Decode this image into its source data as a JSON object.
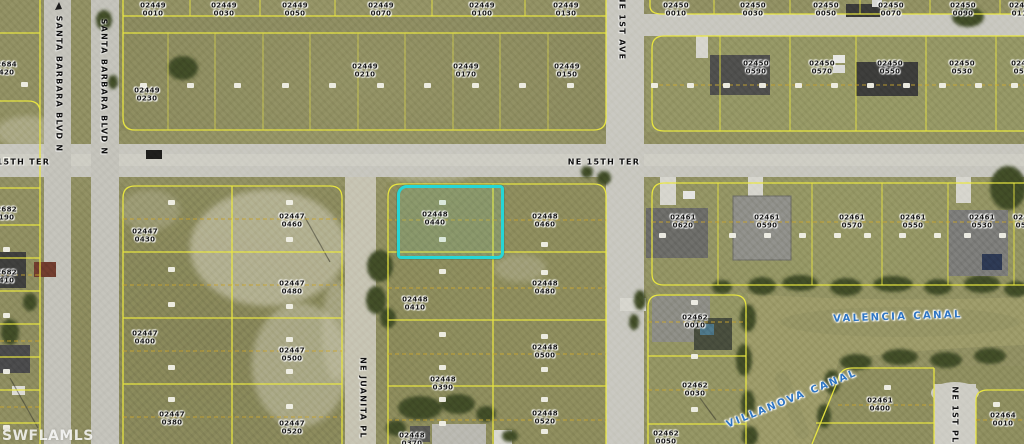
{
  "map": {
    "watermark": "SWFLAMLS",
    "colors": {
      "highlight": "#26d6d6",
      "parcel_line": "#ece93f",
      "parcel_line_dashed": "#c9a42e",
      "canal_text": "#2f76c4",
      "road": "#c7c6be",
      "land": "#8f8e61",
      "water": "#9b9968"
    },
    "highlighted_parcel": {
      "line1": "02448",
      "line2": "0440",
      "x": 397,
      "y": 185,
      "width": 101,
      "height": 68
    },
    "parcel_labels": [
      {
        "line1": "02449",
        "line2": "0010",
        "x": 153,
        "y": 10
      },
      {
        "line1": "02449",
        "line2": "0030",
        "x": 224,
        "y": 10
      },
      {
        "line1": "02449",
        "line2": "0050",
        "x": 295,
        "y": 10
      },
      {
        "line1": "02449",
        "line2": "0070",
        "x": 381,
        "y": 10
      },
      {
        "line1": "02449",
        "line2": "0100",
        "x": 482,
        "y": 10
      },
      {
        "line1": "02449",
        "line2": "0130",
        "x": 566,
        "y": 10
      },
      {
        "line1": "02449",
        "line2": "0230",
        "x": 147,
        "y": 95
      },
      {
        "line1": "02449",
        "line2": "0210",
        "x": 365,
        "y": 71
      },
      {
        "line1": "02449",
        "line2": "0170",
        "x": 466,
        "y": 71
      },
      {
        "line1": "02449",
        "line2": "0150",
        "x": 567,
        "y": 71
      },
      {
        "line1": "02450",
        "line2": "0010",
        "x": 676,
        "y": 10
      },
      {
        "line1": "02450",
        "line2": "0030",
        "x": 753,
        "y": 10
      },
      {
        "line1": "02450",
        "line2": "0050",
        "x": 826,
        "y": 10
      },
      {
        "line1": "02450",
        "line2": "0070",
        "x": 891,
        "y": 10
      },
      {
        "line1": "02450",
        "line2": "0090",
        "x": 963,
        "y": 10
      },
      {
        "line1": "02450",
        "line2": "0110",
        "x": 1022,
        "y": 10
      },
      {
        "line1": "02450",
        "line2": "0590",
        "x": 756,
        "y": 68
      },
      {
        "line1": "02450",
        "line2": "0570",
        "x": 822,
        "y": 68
      },
      {
        "line1": "02450",
        "line2": "0550",
        "x": 890,
        "y": 68
      },
      {
        "line1": "02450",
        "line2": "0530",
        "x": 962,
        "y": 68
      },
      {
        "line1": "02450",
        "line2": "0510",
        "x": 1024,
        "y": 68
      },
      {
        "line1": "02684",
        "line2": "0420",
        "x": 4,
        "y": 69
      },
      {
        "line1": "02682",
        "line2": "0190",
        "x": 4,
        "y": 214
      },
      {
        "line1": "02682",
        "line2": "0410",
        "x": 4,
        "y": 277
      },
      {
        "line1": "02447",
        "line2": "0430",
        "x": 145,
        "y": 236
      },
      {
        "line1": "02447",
        "line2": "0460",
        "x": 292,
        "y": 221
      },
      {
        "line1": "02447",
        "line2": "0480",
        "x": 292,
        "y": 288
      },
      {
        "line1": "02447",
        "line2": "0400",
        "x": 145,
        "y": 338
      },
      {
        "line1": "02447",
        "line2": "0500",
        "x": 292,
        "y": 355
      },
      {
        "line1": "02447",
        "line2": "0380",
        "x": 172,
        "y": 419
      },
      {
        "line1": "02447",
        "line2": "0520",
        "x": 292,
        "y": 428
      },
      {
        "line1": "02448",
        "line2": "0440",
        "x": 435,
        "y": 219
      },
      {
        "line1": "02448",
        "line2": "0460",
        "x": 545,
        "y": 221
      },
      {
        "line1": "02448",
        "line2": "0480",
        "x": 545,
        "y": 288
      },
      {
        "line1": "02448",
        "line2": "0410",
        "x": 415,
        "y": 304
      },
      {
        "line1": "02448",
        "line2": "0500",
        "x": 545,
        "y": 352
      },
      {
        "line1": "02448",
        "line2": "0390",
        "x": 443,
        "y": 384
      },
      {
        "line1": "02448",
        "line2": "0520",
        "x": 545,
        "y": 418
      },
      {
        "line1": "02448",
        "line2": "0370",
        "x": 412,
        "y": 440
      },
      {
        "line1": "02461",
        "line2": "0620",
        "x": 683,
        "y": 222
      },
      {
        "line1": "02461",
        "line2": "0590",
        "x": 767,
        "y": 222
      },
      {
        "line1": "02461",
        "line2": "0570",
        "x": 852,
        "y": 222
      },
      {
        "line1": "02461",
        "line2": "0550",
        "x": 913,
        "y": 222
      },
      {
        "line1": "02461",
        "line2": "0530",
        "x": 982,
        "y": 222
      },
      {
        "line1": "02461",
        "line2": "0510",
        "x": 1026,
        "y": 222
      },
      {
        "line1": "02461",
        "line2": "0400",
        "x": 880,
        "y": 405
      },
      {
        "line1": "02462",
        "line2": "0010",
        "x": 695,
        "y": 322
      },
      {
        "line1": "02462",
        "line2": "0030",
        "x": 695,
        "y": 390
      },
      {
        "line1": "02462",
        "line2": "0050",
        "x": 666,
        "y": 438
      },
      {
        "line1": "02464",
        "line2": "0010",
        "x": 1003,
        "y": 420
      }
    ],
    "street_labels": [
      {
        "text": "SANTA BARBARA BLVD N",
        "x": 59,
        "y": 84,
        "rotation": 90
      },
      {
        "text": "SANTA BARBARA BLVD N",
        "x": 104,
        "y": 87,
        "rotation": 90
      },
      {
        "text": "NE 15TH TER",
        "x": 14,
        "y": 162,
        "rotation": 0
      },
      {
        "text": "NE 15TH TER",
        "x": 604,
        "y": 162,
        "rotation": 0
      },
      {
        "text": "NE 1ST AVE",
        "x": 622,
        "y": 28,
        "rotation": 90
      },
      {
        "text": "NE JUANITA PL",
        "x": 363,
        "y": 398,
        "rotation": 90
      },
      {
        "text": "NE 1ST PL",
        "x": 955,
        "y": 415,
        "rotation": 90
      }
    ],
    "canal_labels": [
      {
        "text": "VALENCIA CANAL",
        "x": 898,
        "y": 317,
        "rotation": -2
      },
      {
        "text": "VILLANOVA CANAL",
        "x": 792,
        "y": 399,
        "rotation": -22
      }
    ]
  }
}
